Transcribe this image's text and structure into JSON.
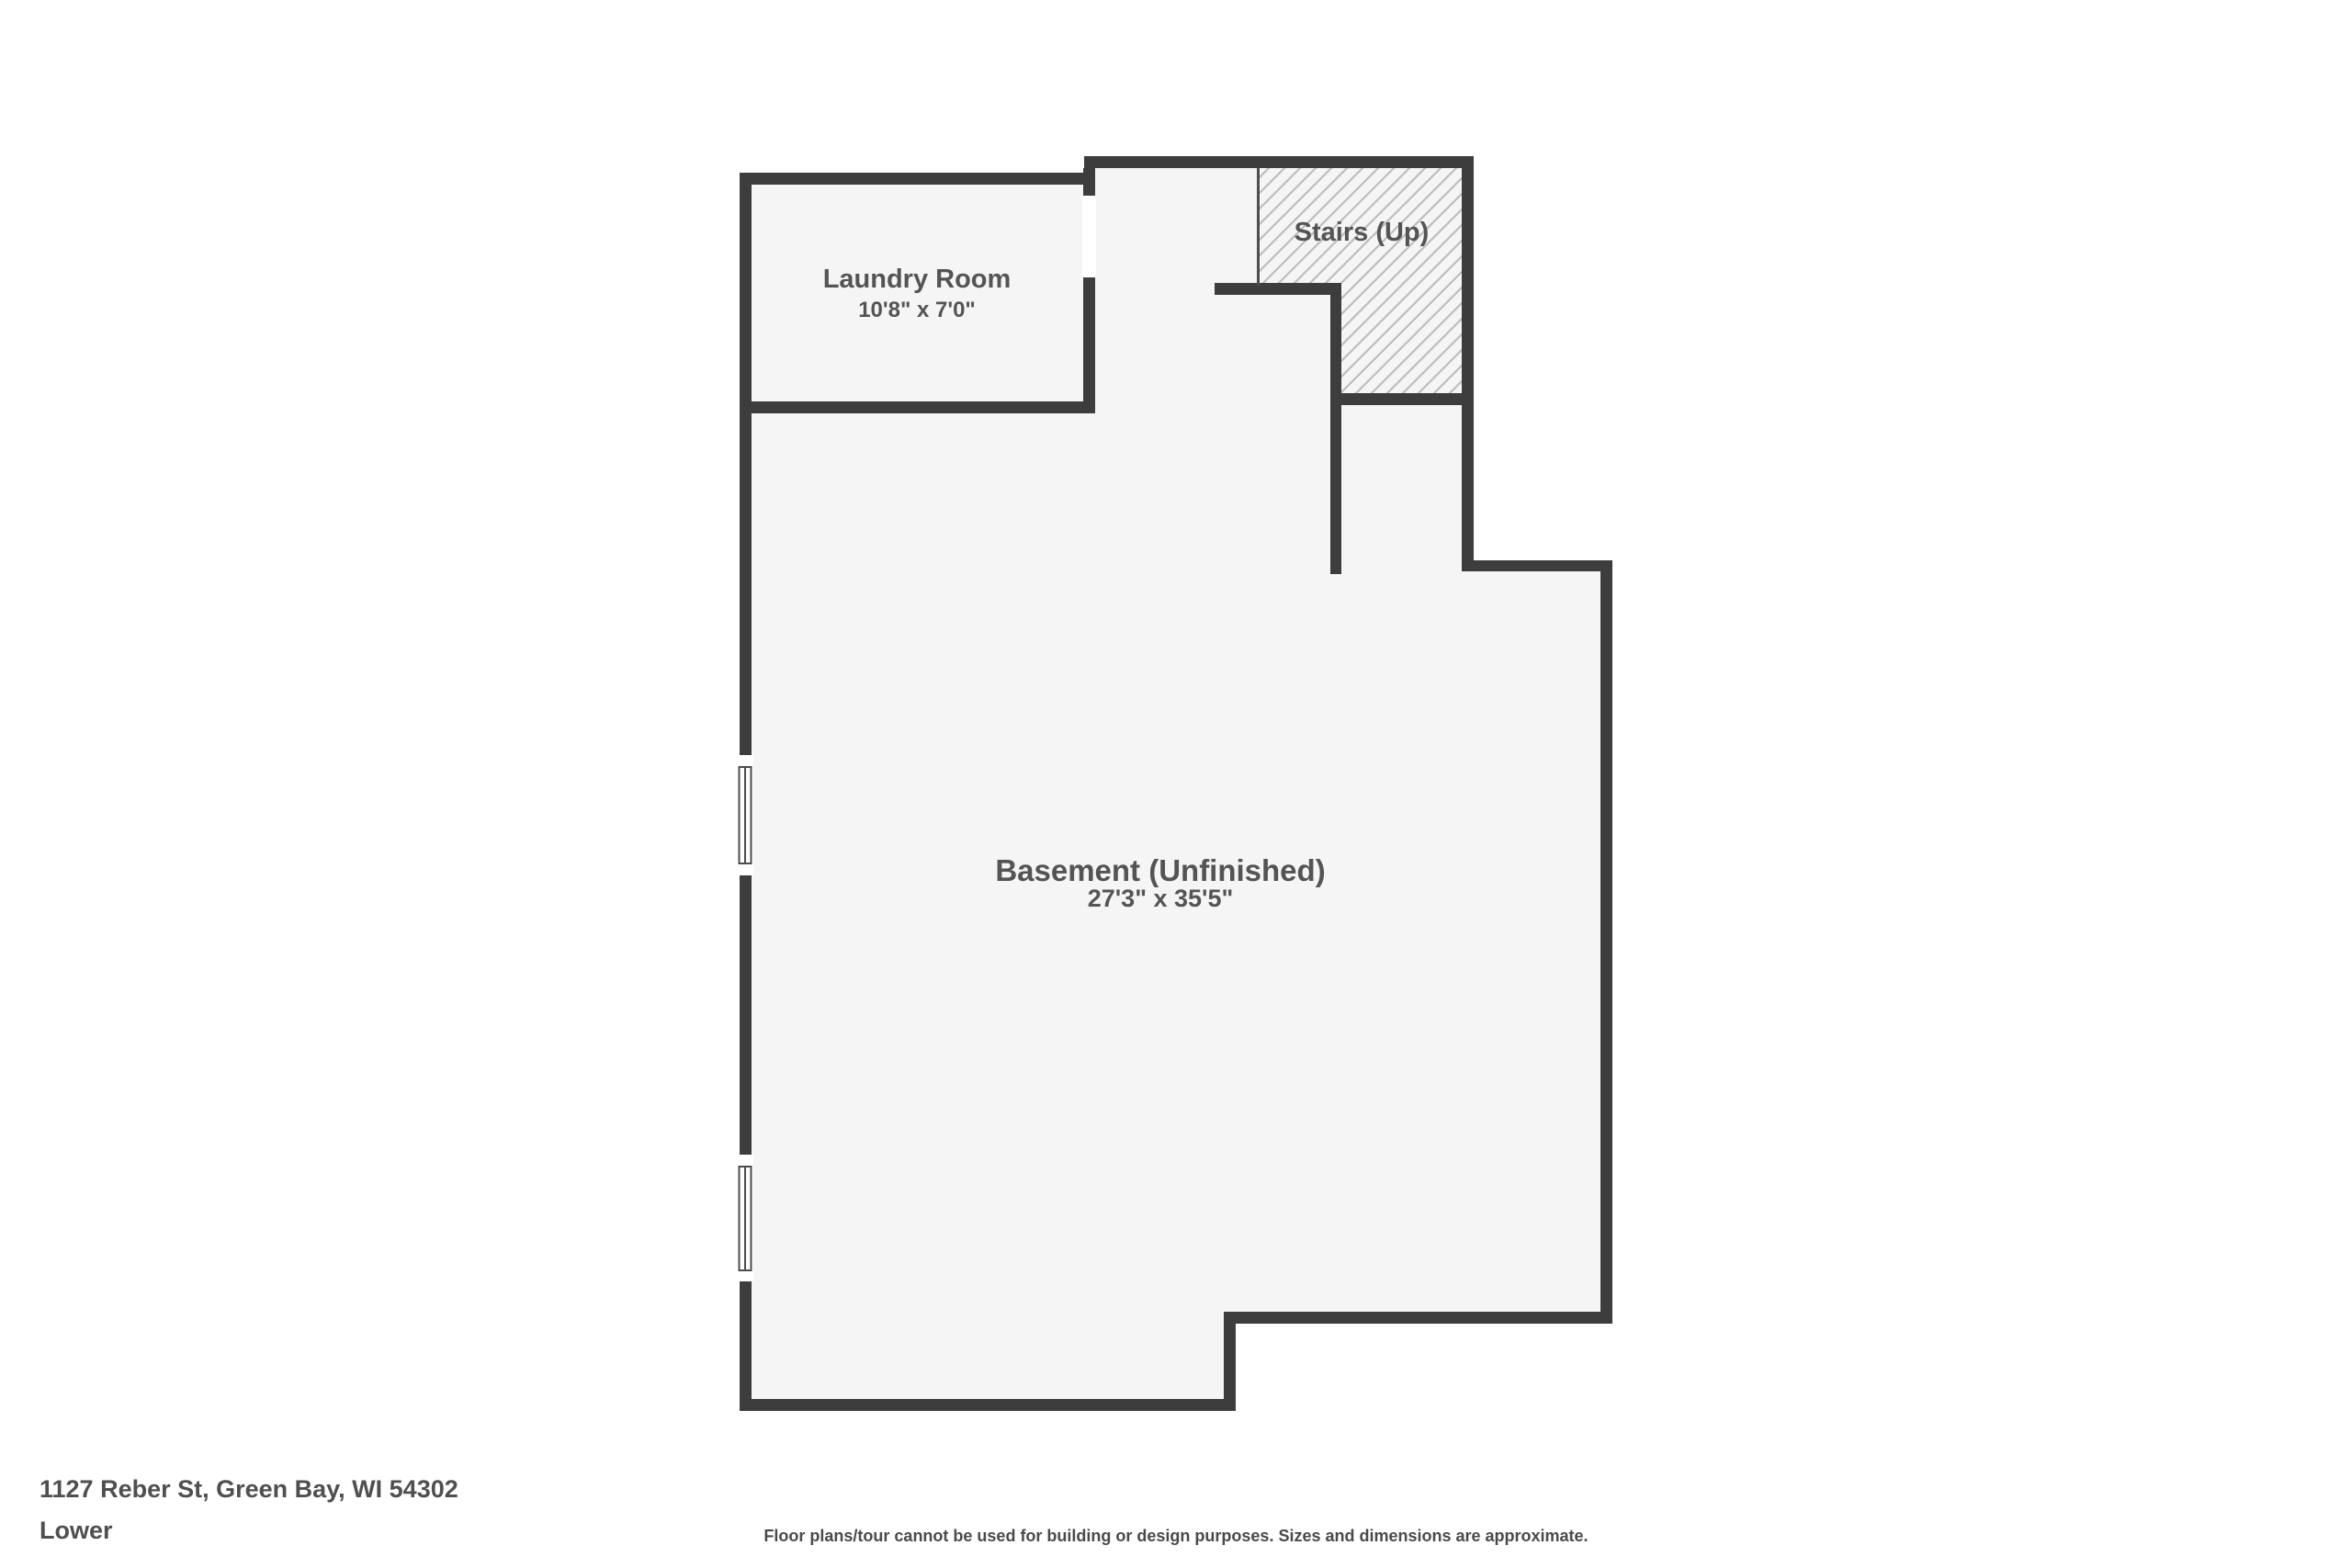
{
  "floorplan": {
    "laundry": {
      "name": "Laundry Room",
      "dimensions": "10'8\" x 7'0\""
    },
    "stairs": {
      "name": "Stairs (Up)"
    },
    "basement": {
      "name": "Basement (Unfinished)",
      "dimensions": "27'3\" x 35'5\""
    }
  },
  "footer": {
    "address": "1127 Reber St, Green Bay, WI 54302",
    "level": "Lower",
    "disclaimer": "Floor plans/tour cannot be used for building or design purposes. Sizes and dimensions are approximate."
  },
  "colors": {
    "background": "#ffffff",
    "floor": "#f5f5f5",
    "wall": "#3d3d3d",
    "hatch_line": "#bdbdbd",
    "window_frame": "#4d4d4d",
    "label_text": "#545454",
    "footer_text": "#4f4f4f"
  }
}
